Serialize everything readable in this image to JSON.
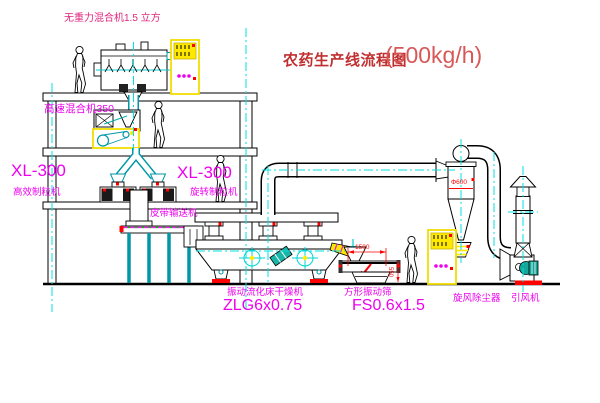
{
  "title": {
    "text": "农药生产线流程图",
    "capacity": "(500kg/h)"
  },
  "labels": {
    "top_mixer": "无重力混合机1.5 立方",
    "high_speed_mixer": "高速混合机350",
    "granulator_left_model": "XL-300",
    "granulator_left_name": "高效制粒机",
    "granulator_right_model": "XL-300",
    "granulator_right_name": "旋转制粒机",
    "belt_conveyor": "皮带输送机",
    "dryer_name": "振动流化床干燥机",
    "dryer_model": "ZLG6x0.75",
    "screen_name": "方形振动筛",
    "screen_model": "FS0.6x1.5",
    "cyclone": "旋风除尘器",
    "fan": "引风机"
  },
  "dimensions": {
    "screen_length": "1500",
    "screen_height": "550",
    "cyclone_dia": "Φ600"
  },
  "colors": {
    "label_magenta": "#ee00ee",
    "title_red": "#c03030",
    "capacity_red": "#d85858",
    "annotation_red": "#ff0000",
    "centerline_cyan": "#00e0e0",
    "machine_teal": "#0097a7",
    "cabinet_yellow": "#f2e000"
  }
}
